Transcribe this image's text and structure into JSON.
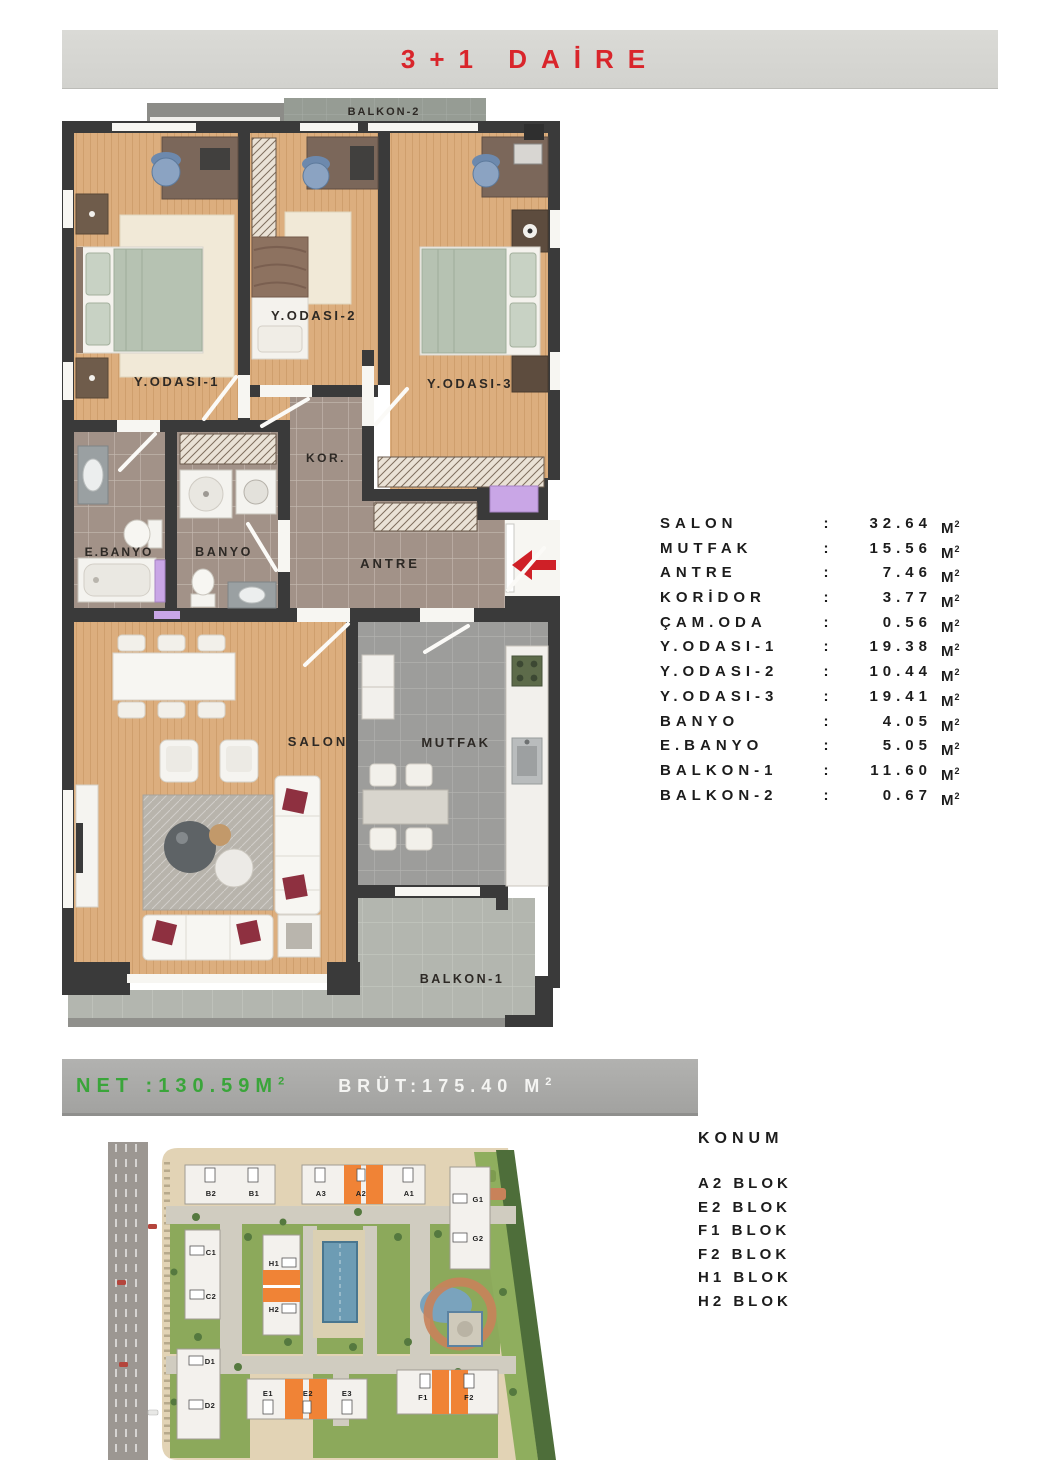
{
  "header": {
    "title": "3+1 DAİRE"
  },
  "floor_plan": {
    "labels": {
      "balkon2": "BALKON-2",
      "yodasi1": "Y.ODASI-1",
      "yodasi2": "Y.ODASI-2",
      "yodasi3": "Y.ODASI-3",
      "kor": "KOR.",
      "ebanyo": "E.BANYO",
      "banyo": "BANYO",
      "antre": "ANTRE",
      "salon": "SALON",
      "mutfak": "MUTFAK",
      "balkon1": "BALKON-1"
    }
  },
  "areas": {
    "colon": ":",
    "unit": "M",
    "sup": "2",
    "rows": [
      {
        "name": "SALON",
        "value": "32.64"
      },
      {
        "name": "MUTFAK",
        "value": "15.56"
      },
      {
        "name": "ANTRE",
        "value": "7.46"
      },
      {
        "name": "KORİDOR",
        "value": "3.77"
      },
      {
        "name": "ÇAM.ODA",
        "value": "0.56"
      },
      {
        "name": "Y.ODASI-1",
        "value": "19.38"
      },
      {
        "name": "Y.ODASI-2",
        "value": "10.44"
      },
      {
        "name": "Y.ODASI-3",
        "value": "19.41"
      },
      {
        "name": "BANYO",
        "value": "4.05"
      },
      {
        "name": "E.BANYO",
        "value": "5.05"
      },
      {
        "name": "BALKON-1",
        "value": "11.60"
      },
      {
        "name": "BALKON-2",
        "value": "0.67"
      }
    ]
  },
  "summary": {
    "net": "NET :130.59M",
    "brut": "BRÜT:175.40 M",
    "sup": "2"
  },
  "site_plan": {
    "blocks": {
      "b2": "B2",
      "b1": "B1",
      "a3": "A3",
      "a2": "A2",
      "a1": "A1",
      "g1": "G1",
      "g2": "G2",
      "c1": "C1",
      "c2": "C2",
      "h1": "H1",
      "h2": "H2",
      "d1": "D1",
      "d2": "D2",
      "e1": "E1",
      "e2": "E2",
      "e3": "E3",
      "f1": "F1",
      "f2": "F2"
    }
  },
  "konum": {
    "heading": "KONUM",
    "items": [
      "A2 BLOK",
      "E2 BLOK",
      "F1 BLOK",
      "F2 BLOK",
      "H1 BLOK",
      "H2 BLOK"
    ]
  },
  "colors": {
    "title_red": "#d9252b",
    "net_green": "#3aa53a",
    "banner_gray": "#a7a7a5",
    "header_gray": "#d6d6d2",
    "highlight_orange": "#f08336",
    "arrow_red": "#cf2027",
    "wall_dark": "#3a3a3a",
    "wood_floor": "#dcae7e"
  }
}
